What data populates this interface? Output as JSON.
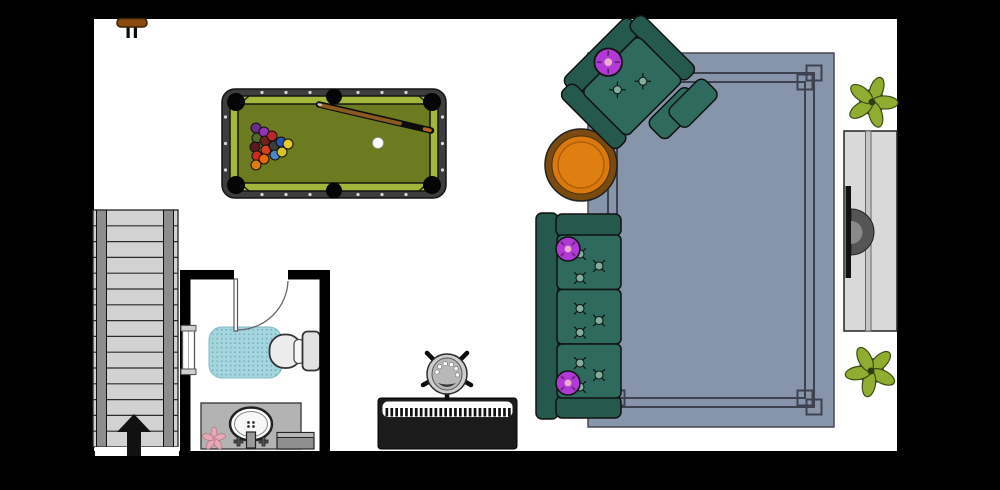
{
  "app": {
    "view_label": "floor-plan"
  },
  "colors": {
    "wall": "#000000",
    "floor": "#ffffff",
    "sofa_body": "#2e6a5d",
    "sofa_back": "#26594e",
    "button": "#7fae9d",
    "pillow": "#b13ad4",
    "pillow_center": "#ecaacd",
    "rug": "#8695a9",
    "rug_border": "#3d434e",
    "table_rim": "#7a4a10",
    "table_top": "#d9790f",
    "table_top_inner": "#de7f10",
    "felt": "#6c7a20",
    "rail": "#a2b83a",
    "pool_frame": "#3d3d3d",
    "cue_shaft": "#8a5a1e",
    "plant_leaf": "#8fae2f",
    "plant_core": "#3f3f3f",
    "stairs_tread": "#d2d2d2",
    "stairs_stringer": "#8d8d8d",
    "mat": "#a5d6de",
    "mat_dot": "#6fb3c0",
    "toilet": "#ececec",
    "tank": "#e2e2e2",
    "vanity": "#b3b3b3",
    "console": "#d9d9d9",
    "tv": "#111111",
    "tv_stand": "#555555",
    "wood": "#8a4a10",
    "piano_body": "#1b1b1b",
    "flower": "#e8a9b6",
    "arrow": "#111111"
  },
  "pool_table": {
    "ball_radius": 5,
    "balls": [
      [
        256,
        128,
        "#6b2d8c"
      ],
      [
        257,
        138,
        "#55682c"
      ],
      [
        255,
        147,
        "#5c1a1f"
      ],
      [
        257,
        156,
        "#cc2a22"
      ],
      [
        256,
        165,
        "#e07d12"
      ],
      [
        264,
        132,
        "#9232b4"
      ],
      [
        265,
        141,
        "#6e2218"
      ],
      [
        266,
        150,
        "#d8401c"
      ],
      [
        264,
        159,
        "#e8680f"
      ],
      [
        272,
        136,
        "#b82828"
      ],
      [
        274,
        146,
        "#3d3d3d"
      ],
      [
        275,
        155,
        "#4a86c8"
      ],
      [
        281,
        142,
        "#2a52b8"
      ],
      [
        282,
        152,
        "#d8c22c"
      ],
      [
        288,
        144,
        "#e3cb2f"
      ]
    ],
    "cue_ball": [
      378,
      143
    ],
    "sights": {
      "top_xs": [
        262,
        286,
        310,
        358,
        382,
        406
      ],
      "top_y": 92.5,
      "bottom_y": 194.5,
      "side_ys": [
        117,
        143.5,
        170
      ],
      "left_x": 225.5,
      "right_x": 442.5
    }
  },
  "stairs": {
    "steps": 15,
    "top": 210,
    "bottom": 447
  },
  "piano": {
    "key_count": 26,
    "x0": 385.5,
    "step": 4.9
  },
  "sofa": {
    "cushion_ys": [
      235,
      289.5,
      344
    ],
    "tuft_offsets": [
      [
        23,
        19
      ],
      [
        42,
        31
      ],
      [
        23,
        43
      ]
    ]
  },
  "items": [
    "wood-stool",
    "pool-table",
    "armchair",
    "coffee-table",
    "rug",
    "sofa",
    "tv-console",
    "tv",
    "plant-top",
    "plant-bottom",
    "stairs",
    "up-arrow",
    "bathroom",
    "door",
    "window",
    "bath-mat",
    "toilet",
    "vanity",
    "sink",
    "waste-bin",
    "flower",
    "piano",
    "piano-stool"
  ]
}
